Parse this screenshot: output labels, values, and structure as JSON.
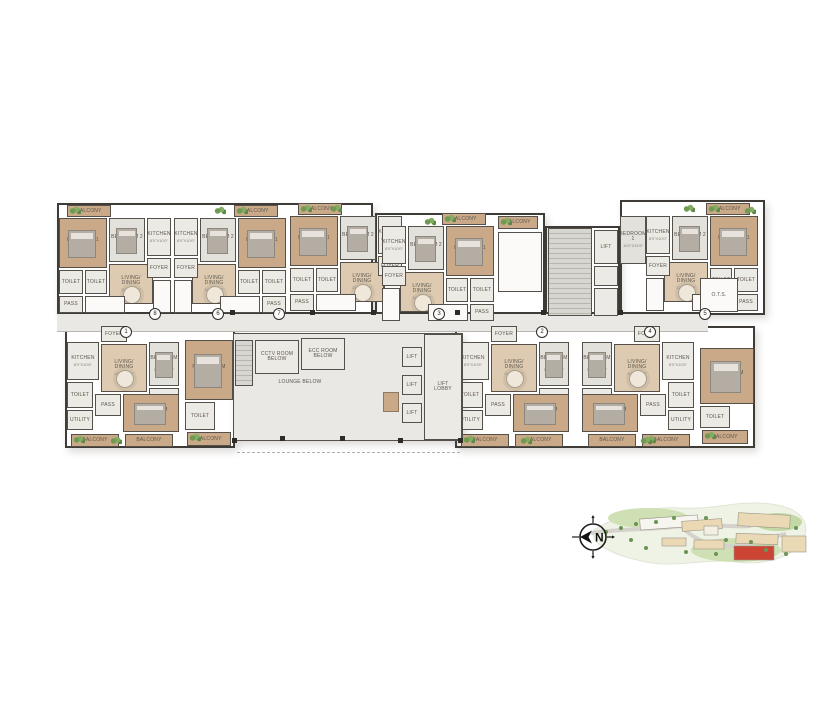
{
  "title": "typical-floor-plan",
  "colors": {
    "wall": "#55504a",
    "wood": "#c9a988",
    "wood_light": "#ddcab0",
    "gray_room": "#eceae5",
    "carpet": "#e3e1dc",
    "void_white": "#fbfaf8",
    "corridor": "#e9e8e4",
    "highlight_building": "#cc4434",
    "green": "#6b9455"
  },
  "core_labels": {
    "lift": "LIFT",
    "lift_lobby": "LIFT\nLOBBY",
    "lounge_below": "LOUNGE BELOW",
    "cctv_room": "CCTV ROOM\nBELOW",
    "ecc_room": "ECC ROOM\nBELOW",
    "ots": "O.T.S."
  },
  "room_labels": {
    "balcony": "BALCONY",
    "bedroom1": "BEDROOM 1",
    "bedroom2": "BEDROOM 2",
    "master_bedroom": "M.BEDROOM",
    "kitchen": "KITCHEN",
    "living": "LIVING/\nDINING",
    "toilet": "TOILET",
    "pass": "PASS",
    "foyer": "FOYER",
    "utility": "UTILITY"
  },
  "unit_template_top": [
    {
      "name": "balcony",
      "label": "BALCONY",
      "x": 10,
      "y": 0,
      "w": 44,
      "h": 12,
      "f": "t",
      "plant": true
    },
    {
      "name": "bedroom-1",
      "label": "BEDROOM 1",
      "dim": "10'0\"X11'6\"",
      "x": 2,
      "y": 13,
      "w": 48,
      "h": 50,
      "f": "t",
      "furn": "bed"
    },
    {
      "name": "bedroom-2",
      "label": "BEDROOM 2",
      "dim": "10'0\"X10'0\"",
      "x": 52,
      "y": 13,
      "w": 36,
      "h": 44,
      "f": "gr",
      "furn": "bed"
    },
    {
      "name": "kitchen",
      "label": "KITCHEN",
      "dim": "8'0\"X10'0\"",
      "x": 90,
      "y": 13,
      "w": 24,
      "h": 38,
      "f": "g"
    },
    {
      "name": "living-dining",
      "label": "LIVING/\nDINING",
      "dim": "11'0\"X17'0\"",
      "x": 52,
      "y": 59,
      "w": 44,
      "h": 40,
      "f": "lt",
      "furn": "table"
    },
    {
      "name": "toilet",
      "label": "TOILET",
      "x": 2,
      "y": 65,
      "w": 24,
      "h": 24,
      "f": "g"
    },
    {
      "name": "toilet",
      "label": "TOILET",
      "x": 28,
      "y": 65,
      "w": 22,
      "h": 24,
      "f": "g"
    },
    {
      "name": "pass",
      "label": "PASS",
      "x": 2,
      "y": 91,
      "w": 24,
      "h": 17,
      "f": "g"
    },
    {
      "name": "foyer",
      "label": "FOYER",
      "x": 90,
      "y": 53,
      "w": 24,
      "h": 20,
      "f": "g"
    },
    {
      "name": "void",
      "label": "",
      "x": 96,
      "y": 75,
      "w": 18,
      "h": 33,
      "f": "w",
      "xmark": true
    },
    {
      "name": "void",
      "label": "",
      "x": 28,
      "y": 91,
      "w": 40,
      "h": 17,
      "f": "w",
      "xmark": true
    }
  ],
  "unit_template_bottom": [
    {
      "name": "foyer",
      "label": "FOYER",
      "x": 36,
      "y": 0,
      "w": 26,
      "h": 16,
      "f": "g"
    },
    {
      "name": "kitchen",
      "label": "KITCHEN",
      "dim": "8'0\"X10'6\"",
      "x": 2,
      "y": 16,
      "w": 32,
      "h": 38,
      "f": "g"
    },
    {
      "name": "living-dining",
      "label": "LIVING/\nDINING",
      "dim": "11'0\"X18'6\"",
      "x": 36,
      "y": 18,
      "w": 46,
      "h": 48,
      "f": "lt",
      "furn": "table"
    },
    {
      "name": "bedroom-2",
      "label": "BEDROOM 2",
      "dim": "10'0\"X10'6\"",
      "x": 84,
      "y": 16,
      "w": 30,
      "h": 44,
      "f": "gr",
      "furn": "bed"
    },
    {
      "name": "toilet",
      "label": "TOILET",
      "x": 84,
      "y": 62,
      "w": 30,
      "h": 24,
      "f": "g"
    },
    {
      "name": "master-bedroom",
      "label": "M.BEDROOM",
      "dim": "11'0\"X12'0\"",
      "x": 58,
      "y": 68,
      "w": 56,
      "h": 38,
      "f": "t",
      "furn": "bed"
    },
    {
      "name": "pass",
      "label": "PASS",
      "x": 30,
      "y": 68,
      "w": 26,
      "h": 22,
      "f": "g"
    },
    {
      "name": "toilet",
      "label": "TOILET",
      "x": 2,
      "y": 56,
      "w": 26,
      "h": 26,
      "f": "g"
    },
    {
      "name": "utility",
      "label": "UTILITY",
      "x": 2,
      "y": 84,
      "w": 26,
      "h": 20,
      "f": "g"
    },
    {
      "name": "balcony",
      "label": "BALCONY",
      "x": 6,
      "y": 108,
      "w": 48,
      "h": 13,
      "f": "t",
      "plant": true
    },
    {
      "name": "balcony",
      "label": "BALCONY",
      "x": 60,
      "y": 108,
      "w": 48,
      "h": 13,
      "f": "t"
    }
  ],
  "units": [
    {
      "id": "unit-top-1",
      "template": "top",
      "x": 57,
      "y": 205,
      "w": 116,
      "mirror": false
    },
    {
      "id": "unit-top-2",
      "template": "top",
      "x": 172,
      "y": 205,
      "w": 116,
      "mirror": true
    },
    {
      "id": "unit-top-3",
      "template": "top",
      "x": 288,
      "y": 203,
      "w": 116,
      "mirror": false
    },
    {
      "id": "unit-top-4",
      "template": "top",
      "x": 380,
      "y": 213,
      "w": 116,
      "mirror": true
    },
    {
      "id": "unit-top-5",
      "template": "top",
      "x": 644,
      "y": 203,
      "w": 116,
      "mirror": true
    },
    {
      "id": "unit-bottom-1",
      "template": "bottom",
      "x": 65,
      "y": 326,
      "w": 116,
      "mirror": false
    },
    {
      "id": "unit-bottom-2",
      "template": "bottom",
      "x": 455,
      "y": 326,
      "w": 116,
      "mirror": false
    },
    {
      "id": "unit-bottom-3",
      "template": "bottom",
      "x": 580,
      "y": 326,
      "w": 116,
      "mirror": true
    }
  ],
  "extra_rooms": [
    {
      "name": "lounge-below",
      "label": "",
      "x": 233,
      "y": 333,
      "w": 230,
      "h": 108,
      "f": "c"
    },
    {
      "name": "staircase",
      "label": "",
      "x": 548,
      "y": 228,
      "w": 44,
      "h": 88,
      "f": "st"
    },
    {
      "name": "lift",
      "label": "LIFT",
      "x": 594,
      "y": 230,
      "w": 24,
      "h": 34,
      "f": "g"
    },
    {
      "name": "duct",
      "label": "",
      "x": 594,
      "y": 266,
      "w": 24,
      "h": 20,
      "f": "g"
    },
    {
      "name": "pass",
      "label": "",
      "x": 594,
      "y": 288,
      "w": 24,
      "h": 28,
      "f": "g"
    },
    {
      "name": "staircase",
      "label": "",
      "x": 235,
      "y": 340,
      "w": 18,
      "h": 46,
      "f": "st"
    },
    {
      "name": "cctv-room",
      "label": "CCTV ROOM\nBELOW",
      "x": 255,
      "y": 340,
      "w": 44,
      "h": 34,
      "f": "g"
    },
    {
      "name": "ecc-room",
      "label": "ECC ROOM\nBELOW",
      "x": 301,
      "y": 338,
      "w": 44,
      "h": 32,
      "f": "g"
    },
    {
      "name": "lift",
      "label": "LIFT",
      "x": 402,
      "y": 347,
      "w": 20,
      "h": 20,
      "f": "g"
    },
    {
      "name": "lift",
      "label": "LIFT",
      "x": 402,
      "y": 375,
      "w": 20,
      "h": 20,
      "f": "g"
    },
    {
      "name": "lift",
      "label": "LIFT",
      "x": 402,
      "y": 403,
      "w": 20,
      "h": 20,
      "f": "g"
    },
    {
      "name": "lift-lobby",
      "label": "LIFT\nLOBBY",
      "x": 424,
      "y": 334,
      "w": 38,
      "h": 106,
      "f": "g"
    },
    {
      "name": "ots",
      "label": "O.T.S.",
      "x": 700,
      "y": 278,
      "w": 38,
      "h": 34,
      "f": "w",
      "xmark": true
    },
    {
      "name": "balcony",
      "label": "BALCONY",
      "x": 498,
      "y": 216,
      "w": 40,
      "h": 13,
      "f": "t",
      "plant": true
    },
    {
      "name": "void",
      "label": "",
      "x": 498,
      "y": 232,
      "w": 44,
      "h": 60,
      "f": "w",
      "xmark": true
    },
    {
      "name": "master-bedroom",
      "label": "M.BEDROOM",
      "dim": "11'0\"X12'6\"",
      "x": 185,
      "y": 340,
      "w": 48,
      "h": 60,
      "f": "t",
      "furn": "bed"
    },
    {
      "name": "toilet",
      "label": "TOILET",
      "x": 185,
      "y": 402,
      "w": 30,
      "h": 28,
      "f": "g"
    },
    {
      "name": "balcony",
      "label": "BALCONY",
      "x": 187,
      "y": 432,
      "w": 44,
      "h": 14,
      "f": "t",
      "plant": true
    },
    {
      "name": "master-bedroom",
      "label": "M.BEDROOM",
      "dim": "11'0\"X12'0\"",
      "x": 700,
      "y": 348,
      "w": 54,
      "h": 56,
      "f": "t",
      "furn": "bed"
    },
    {
      "name": "toilet",
      "label": "TOILET",
      "x": 700,
      "y": 406,
      "w": 30,
      "h": 22,
      "f": "g"
    },
    {
      "name": "balcony",
      "label": "BALCONY",
      "x": 702,
      "y": 430,
      "w": 46,
      "h": 14,
      "f": "t",
      "plant": true
    },
    {
      "name": "bedroom-1",
      "label": "BEDROOM 1",
      "dim": "10'0\"X11'6\"",
      "x": 620,
      "y": 216,
      "w": 26,
      "h": 48,
      "f": "gr"
    },
    {
      "name": "lounge-label",
      "label": "LOUNGE BELOW",
      "x": 252,
      "y": 376,
      "w": 96,
      "h": 12,
      "f": "none"
    }
  ],
  "outlines": [
    {
      "name": "wing-top-left",
      "x": 57,
      "y": 203,
      "w": 316,
      "h": 112
    },
    {
      "name": "wing-top-mid",
      "x": 375,
      "y": 213,
      "w": 170,
      "h": 102
    },
    {
      "name": "stair-core",
      "x": 545,
      "y": 226,
      "w": 75,
      "h": 90
    },
    {
      "name": "wing-top-right",
      "x": 620,
      "y": 200,
      "w": 145,
      "h": 115
    },
    {
      "name": "wing-bottom-left",
      "x": 65,
      "y": 326,
      "w": 170,
      "h": 122
    },
    {
      "name": "lobby-core",
      "x": 233,
      "y": 333,
      "w": 230,
      "h": 108
    },
    {
      "name": "wing-bottom-right",
      "x": 455,
      "y": 326,
      "w": 300,
      "h": 122
    }
  ],
  "corridor": {
    "x": 57,
    "y": 312,
    "w": 651,
    "h": 20
  },
  "dashed_line": {
    "x": 237,
    "y": 452,
    "w": 223
  },
  "markers": [
    {
      "n": "1",
      "x": 125,
      "y": 331
    },
    {
      "n": "8",
      "x": 154,
      "y": 313
    },
    {
      "n": "6",
      "x": 217,
      "y": 313
    },
    {
      "n": "7",
      "x": 278,
      "y": 313
    },
    {
      "n": "3",
      "x": 438,
      "y": 313
    },
    {
      "n": "2",
      "x": 541,
      "y": 331
    },
    {
      "n": "4",
      "x": 649,
      "y": 331
    },
    {
      "n": "5",
      "x": 704,
      "y": 313
    }
  ],
  "columns": [
    {
      "x": 150,
      "y": 310
    },
    {
      "x": 230,
      "y": 310
    },
    {
      "x": 310,
      "y": 310
    },
    {
      "x": 371,
      "y": 310
    },
    {
      "x": 455,
      "y": 310
    },
    {
      "x": 541,
      "y": 310
    },
    {
      "x": 618,
      "y": 310
    },
    {
      "x": 705,
      "y": 310
    },
    {
      "x": 280,
      "y": 436
    },
    {
      "x": 340,
      "y": 436
    },
    {
      "x": 398,
      "y": 438
    },
    {
      "x": 232,
      "y": 438
    },
    {
      "x": 458,
      "y": 438
    }
  ],
  "plants": [
    {
      "x": 214,
      "y": 206
    },
    {
      "x": 330,
      "y": 204
    },
    {
      "x": 424,
      "y": 217
    },
    {
      "x": 683,
      "y": 204
    },
    {
      "x": 744,
      "y": 206
    },
    {
      "x": 110,
      "y": 436
    },
    {
      "x": 520,
      "y": 436
    },
    {
      "x": 640,
      "y": 436
    }
  ],
  "desk": {
    "x": 383,
    "y": 392,
    "w": 14,
    "h": 18
  },
  "compass": {
    "label": "N"
  },
  "sitemap": {
    "buildings": [
      {
        "x": 54,
        "y": 29,
        "w": 58,
        "h": 11,
        "rot": -4,
        "fill": "#f7f5f0"
      },
      {
        "x": 96,
        "y": 32,
        "w": 40,
        "h": 10,
        "rot": -4,
        "fill": "#ead9b4"
      },
      {
        "x": 118,
        "y": 38,
        "w": 14,
        "h": 9,
        "rot": 0,
        "fill": "#f3efe4"
      },
      {
        "x": 152,
        "y": 26,
        "w": 52,
        "h": 13,
        "rot": 3,
        "fill": "#ead9b4"
      },
      {
        "x": 150,
        "y": 46,
        "w": 42,
        "h": 10,
        "rot": 2,
        "fill": "#ead9b4"
      },
      {
        "x": 108,
        "y": 52,
        "w": 30,
        "h": 9,
        "rot": 0,
        "fill": "#ead9b4"
      },
      {
        "x": 76,
        "y": 50,
        "w": 24,
        "h": 8,
        "rot": 0,
        "fill": "#ead9b4"
      },
      {
        "x": 196,
        "y": 48,
        "w": 24,
        "h": 16,
        "rot": 0,
        "fill": "#ead9b4"
      },
      {
        "x": 148,
        "y": 58,
        "w": 40,
        "h": 14,
        "rot": 0,
        "fill": "#cc4434"
      }
    ],
    "trees": [
      {
        "x": 20,
        "y": 44
      },
      {
        "x": 35,
        "y": 40
      },
      {
        "x": 50,
        "y": 36
      },
      {
        "x": 70,
        "y": 34
      },
      {
        "x": 88,
        "y": 30
      },
      {
        "x": 120,
        "y": 30
      },
      {
        "x": 140,
        "y": 52
      },
      {
        "x": 165,
        "y": 54
      },
      {
        "x": 180,
        "y": 62
      },
      {
        "x": 200,
        "y": 66
      },
      {
        "x": 210,
        "y": 40
      },
      {
        "x": 60,
        "y": 60
      },
      {
        "x": 45,
        "y": 52
      },
      {
        "x": 100,
        "y": 64
      },
      {
        "x": 130,
        "y": 66
      }
    ]
  }
}
